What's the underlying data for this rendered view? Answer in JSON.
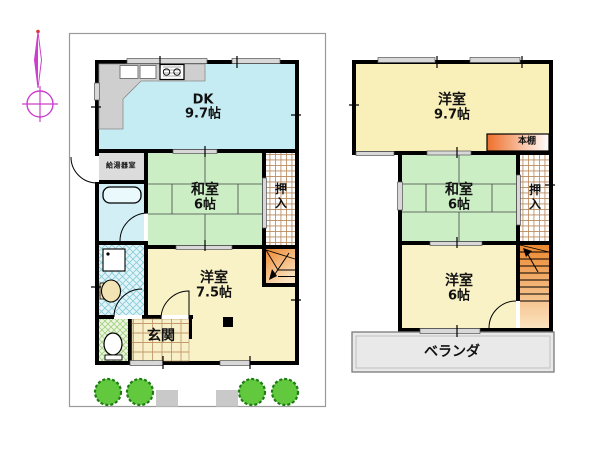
{
  "document": {
    "type": "madori-floor-plan"
  },
  "colors": {
    "wall": "#000000",
    "dk": "#c6ecf3",
    "bath": "#d2eff6",
    "tatami": "#cbeec5",
    "western_1f": "#f9f2c6",
    "western_2f": "#f9efb8",
    "water_heater_room": "#dcdcdc",
    "counter": "#cfcfcf",
    "veranda": "#e9e9e9",
    "stairs_dark": "#ec8830",
    "stairs_light": "#fbe3c0",
    "shelf_dark": "#ee6f2a",
    "boundary": "#9a9a9a",
    "tree": "#62c93f",
    "compass": "#cc3fcc"
  },
  "floor1": {
    "dk": {
      "name": "DK",
      "size": "9.7帖"
    },
    "washitsu": {
      "name": "和室",
      "size": "6帖"
    },
    "oshiire": "押入",
    "youshitsu": {
      "name": "洋室",
      "size": "7.5帖"
    },
    "genkan": "玄関",
    "water_heater": "給湯器室"
  },
  "floor2": {
    "youshitsu_large": {
      "name": "洋室",
      "size": "9.7帖"
    },
    "washitsu": {
      "name": "和室",
      "size": "6帖"
    },
    "oshiire": "押入",
    "youshitsu_small": {
      "name": "洋室",
      "size": "6帖"
    },
    "bookshelf": "本棚",
    "veranda": "ベランダ"
  }
}
